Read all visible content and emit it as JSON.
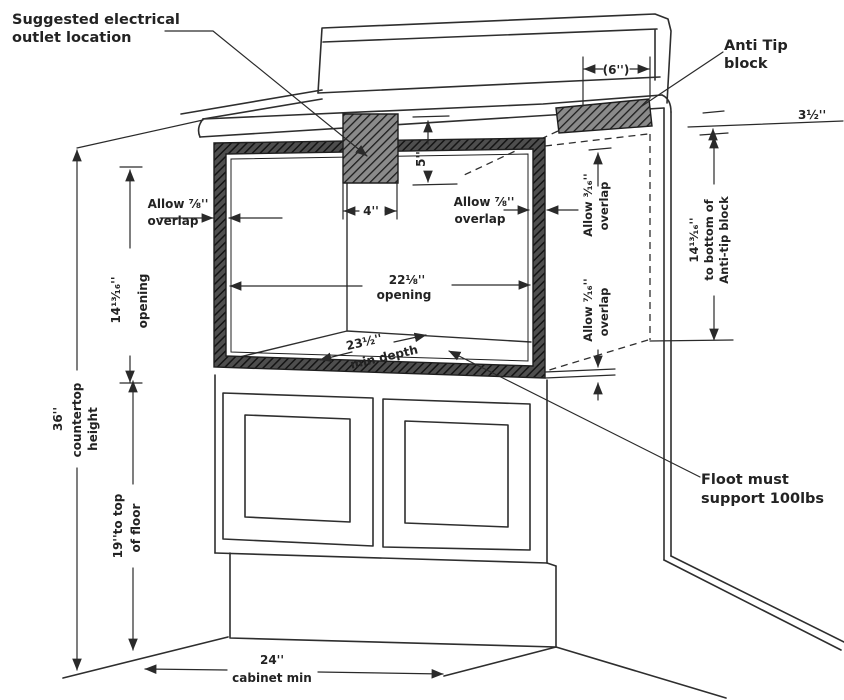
{
  "diagram": {
    "type": "cabinet-installation-drawing",
    "colors": {
      "line": "#2e2e2e",
      "background": "#ffffff",
      "hatch_dark": "#4e4e4e",
      "hatch_block": "#8a8a8a"
    },
    "labels": {
      "outlet_note": {
        "line1": "Suggested electrical",
        "line2": "outlet location"
      },
      "anti_tip_note": {
        "line1": "Anti Tip",
        "line2": "block"
      },
      "floor_note": {
        "line1": "Floot must",
        "line2": "support 100lbs"
      },
      "dim_6in": "(6'')",
      "dim_3_5in": "3½''",
      "dim_5in": "5''",
      "dim_4in": "4''",
      "overlap_left": {
        "line1": "Allow ⅞''",
        "line2": "overlap"
      },
      "overlap_right": {
        "line1": "Allow ⅞''",
        "line2": "overlap"
      },
      "overlap_316": {
        "line1": "Allow ³⁄₁₆''",
        "line2": "overlap"
      },
      "overlap_716": {
        "line1": "Allow ⁷⁄₁₆''",
        "line2": "overlap"
      },
      "opening_width": {
        "line1": "22⅛''",
        "line2": "opening"
      },
      "opening_height": {
        "line1": "14¹³⁄₁₆''",
        "line2": "opening"
      },
      "depth": {
        "line1": "23½''",
        "line2": "min depth"
      },
      "countertop_height": {
        "line1": "36''",
        "line2": "countertop",
        "line3": "height"
      },
      "floor_height": {
        "line1": "19''to top",
        "line2": "of floor"
      },
      "antitip_height": {
        "line1": "14¹³⁄₁₆''",
        "line2": "to bottom of",
        "line3": "Anti-tip block"
      },
      "cabinet_min": {
        "line1": "24''",
        "line2": "cabinet min"
      }
    }
  }
}
